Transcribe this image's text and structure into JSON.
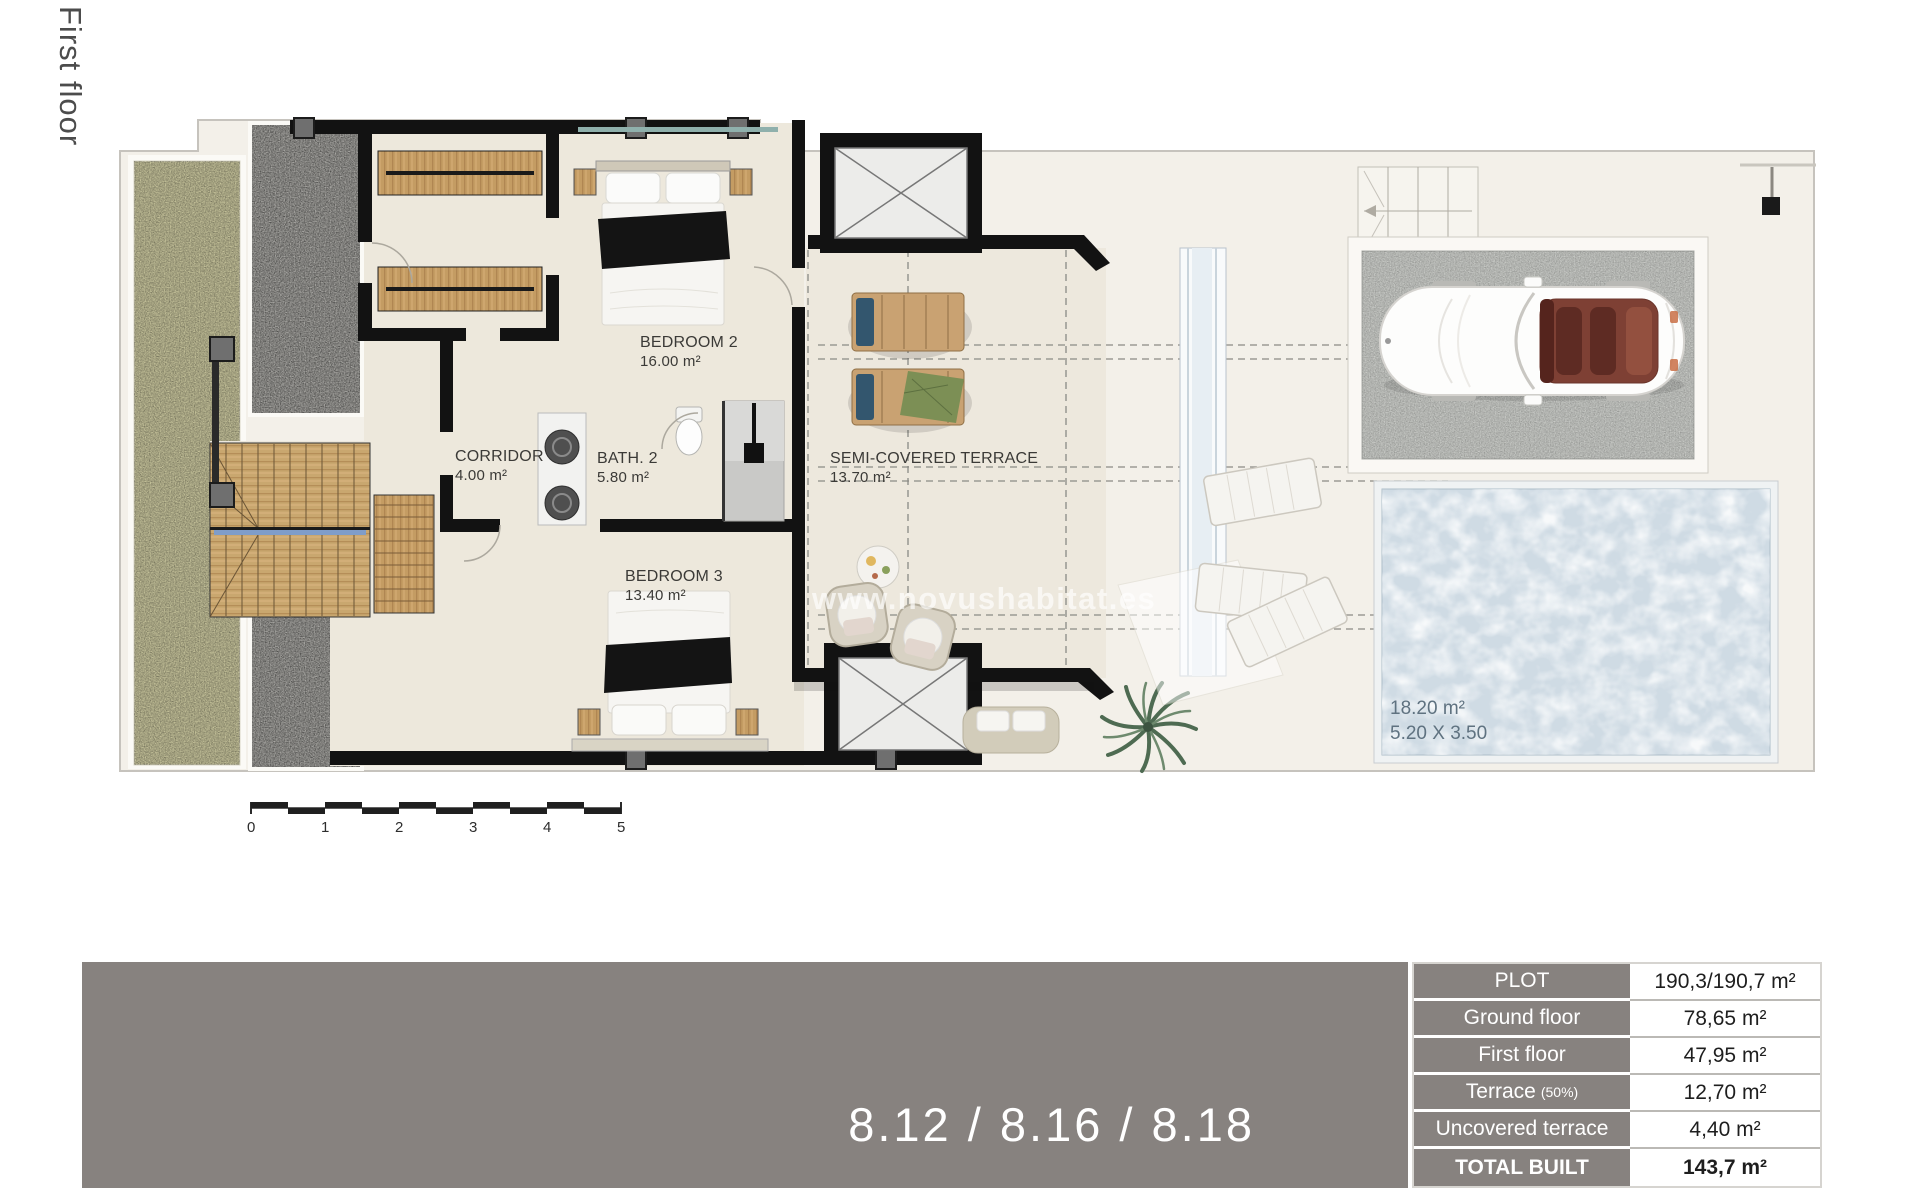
{
  "page": {
    "floor_label": "First floor",
    "watermark": "www.novushabitat.es",
    "unit_numbers": "8.12 / 8.16 / 8.18"
  },
  "rooms": {
    "bedroom2": {
      "name": "BEDROOM 2",
      "area": "16.00 m²"
    },
    "corridor": {
      "name": "CORRIDOR",
      "area": "4.00 m²"
    },
    "bath2": {
      "name": "BATH. 2",
      "area": "5.80 m²"
    },
    "bedroom3": {
      "name": "BEDROOM 3",
      "area": "13.40 m²"
    },
    "terrace": {
      "name": "SEMI-COVERED TERRACE",
      "area": "13.70 m²"
    }
  },
  "pool": {
    "area": "18.20 m²",
    "dimensions": "5.20 X 3.50"
  },
  "scale_bar": {
    "ticks": [
      "0",
      "1",
      "2",
      "3",
      "4",
      "5"
    ]
  },
  "areas_table": {
    "rows": [
      {
        "label": "PLOT",
        "value": "190,3/190,7 m²"
      },
      {
        "label": "Ground floor",
        "value": "78,65 m²"
      },
      {
        "label": "First floor",
        "value": "47,95 m²"
      },
      {
        "label": "Terrace",
        "note": "(50%)",
        "value": "12,70 m²"
      },
      {
        "label": "Uncovered terrace",
        "value": "4,40 m²"
      },
      {
        "label": "TOTAL BUILT",
        "value": "143,7 m²"
      }
    ]
  },
  "colors": {
    "wall": "#121212",
    "floor": "#EDE8DC",
    "garden": "#C6C39B",
    "gravel": "#A8A7A3",
    "pool_water": "#CFDBE4",
    "bar_gray": "#87827F",
    "wood": "#C49C63"
  }
}
